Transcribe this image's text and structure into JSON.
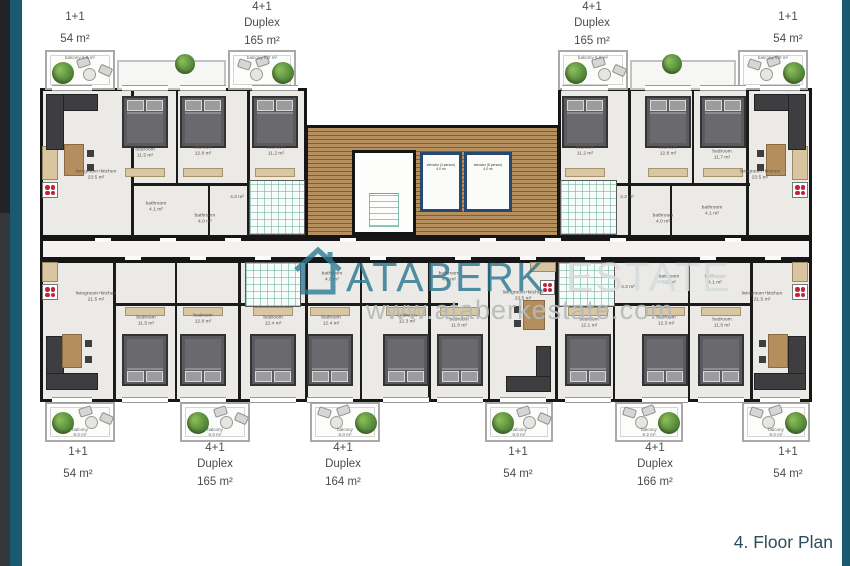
{
  "title": "4. Floor Plan",
  "watermark": {
    "brand_primary": "ATABERK",
    "brand_secondary": "ESTATE",
    "url": "www.ataberkestate.com"
  },
  "units_top": [
    {
      "line1": "1+1",
      "line2": "",
      "area": "54 m²"
    },
    {
      "line1": "4+1",
      "line2": "Duplex",
      "area": "165 m²"
    },
    {
      "line1": "4+1",
      "line2": "Duplex",
      "area": "165 m²"
    },
    {
      "line1": "1+1",
      "line2": "",
      "area": "54 m²"
    }
  ],
  "units_bottom": [
    {
      "line1": "1+1",
      "line2": "",
      "area": "54 m²"
    },
    {
      "line1": "4+1",
      "line2": "Duplex",
      "area": "165 m²"
    },
    {
      "line1": "4+1",
      "line2": "Duplex",
      "area": "164 m²"
    },
    {
      "line1": "1+1",
      "line2": "",
      "area": "54 m²"
    },
    {
      "line1": "4+1",
      "line2": "Duplex",
      "area": "166 m²"
    },
    {
      "line1": "1+1",
      "line2": "",
      "area": "54 m²"
    }
  ],
  "balcony": {
    "name": "balcony",
    "area": "6.0 m²",
    "area_alt": "6.2 m²"
  },
  "elevators": [
    {
      "name": "elevator (4 person)",
      "area": "4.0 m²"
    },
    {
      "name": "elevator (8 person)",
      "area": "4.0 m²"
    }
  ],
  "rooms": [
    {
      "name": "livingroom+kitchen",
      "area": "23.5 m²"
    },
    {
      "name": "bedroom",
      "area": "11.5 m²"
    },
    {
      "name": "bedroom",
      "area": "12.8 m²"
    },
    {
      "name": "bedroom",
      "area": "11.2 m²"
    },
    {
      "name": "bathroom",
      "area": "4.1 m²"
    },
    {
      "name": "bathroom",
      "area": "4.0 m²"
    },
    {
      "name": "",
      "area": "4.3 m²"
    },
    {
      "name": "bedroom",
      "area": "11.2 m²"
    },
    {
      "name": "bedroom",
      "area": "12.8 m²"
    },
    {
      "name": "bedroom",
      "area": "11.7 m²"
    },
    {
      "name": "livingroom+kitchen",
      "area": "23.5 m²"
    },
    {
      "name": "",
      "area": "4.3 m²"
    },
    {
      "name": "bathroom",
      "area": "4.0 m²"
    },
    {
      "name": "bathroom",
      "area": "4.1 m²"
    },
    {
      "name": "livingroom+kitchen",
      "area": "21.5 m²"
    },
    {
      "name": "bedroom",
      "area": "11.5 m²"
    },
    {
      "name": "bedroom",
      "area": "12.8 m²"
    },
    {
      "name": "bedroom",
      "area": "12.4 m²"
    },
    {
      "name": "bedroom",
      "area": "12.4 m²"
    },
    {
      "name": "bedroom",
      "area": "12.3 m²"
    },
    {
      "name": "bedroom",
      "area": "11.5 m²"
    },
    {
      "name": "bathroom",
      "area": "4.0 m²"
    },
    {
      "name": "bathroom",
      "area": "4.3 m²"
    },
    {
      "name": "livingroom+kitchen",
      "area": "23.5 m²"
    },
    {
      "name": "",
      "area": "4.3 m²"
    },
    {
      "name": "bathroom",
      "area": "4.0 m²"
    },
    {
      "name": "bathroom",
      "area": "4.1 m²"
    },
    {
      "name": "bedroom",
      "area": "12.1 m²"
    },
    {
      "name": "bedroom",
      "area": "12.3 m²"
    },
    {
      "name": "bedroom",
      "area": "11.5 m²"
    },
    {
      "name": "livingroom+kitchen",
      "area": "21.5 m²"
    }
  ]
}
